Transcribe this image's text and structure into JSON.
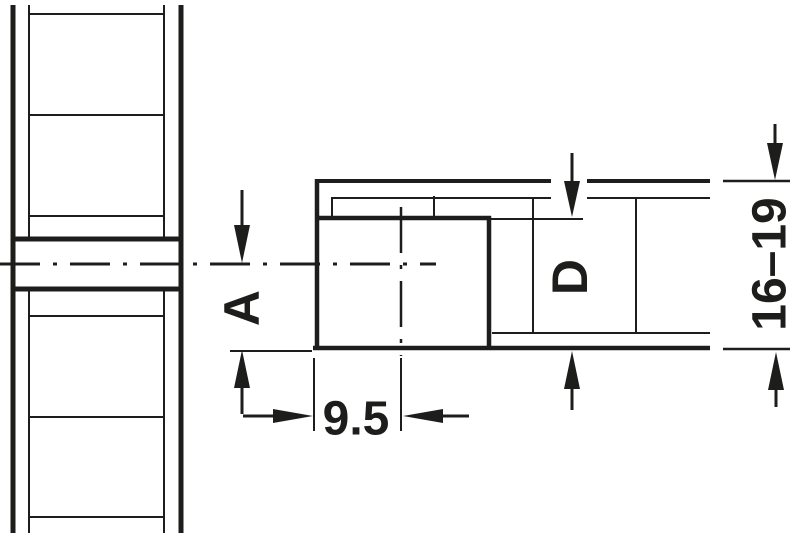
{
  "drawing": {
    "dimension_labels": {
      "a": "A",
      "d": "D",
      "edge_distance": "9.5",
      "panel_thickness_range": "16–19"
    },
    "colors": {
      "line": "#1d1d1b",
      "background": "#ffffff"
    }
  }
}
